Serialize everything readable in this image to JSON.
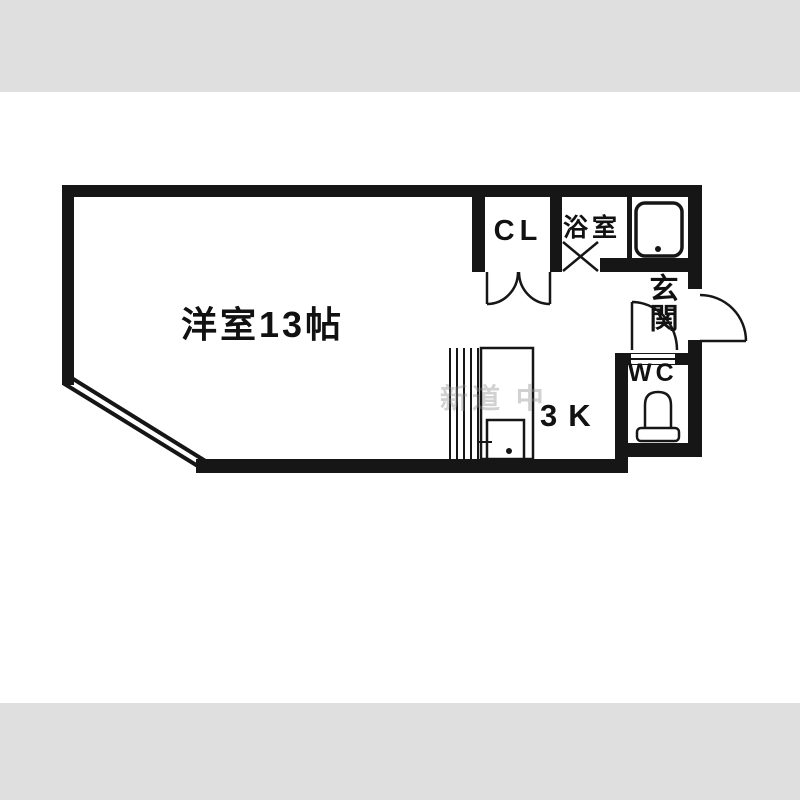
{
  "colors": {
    "background": "#ffffff",
    "band": "#dfdfdf",
    "wall": "#161616",
    "label": "#111111",
    "watermark": "#8f8f8f"
  },
  "floorplan": {
    "labels": {
      "main_room": "洋室13帖",
      "closet": "CL",
      "bathroom": "浴室",
      "entrance": "玄関",
      "toilet": "WC",
      "kitchen": "3K"
    },
    "watermark": "新道 中",
    "icons": {
      "bathtub": "bathtub-icon",
      "toilet": "toilet-icon",
      "kitchen_sink": "kitchen-sink-icon",
      "door_swings": "door-swing-arc-icon",
      "window": "window-diagonal-icon"
    }
  }
}
